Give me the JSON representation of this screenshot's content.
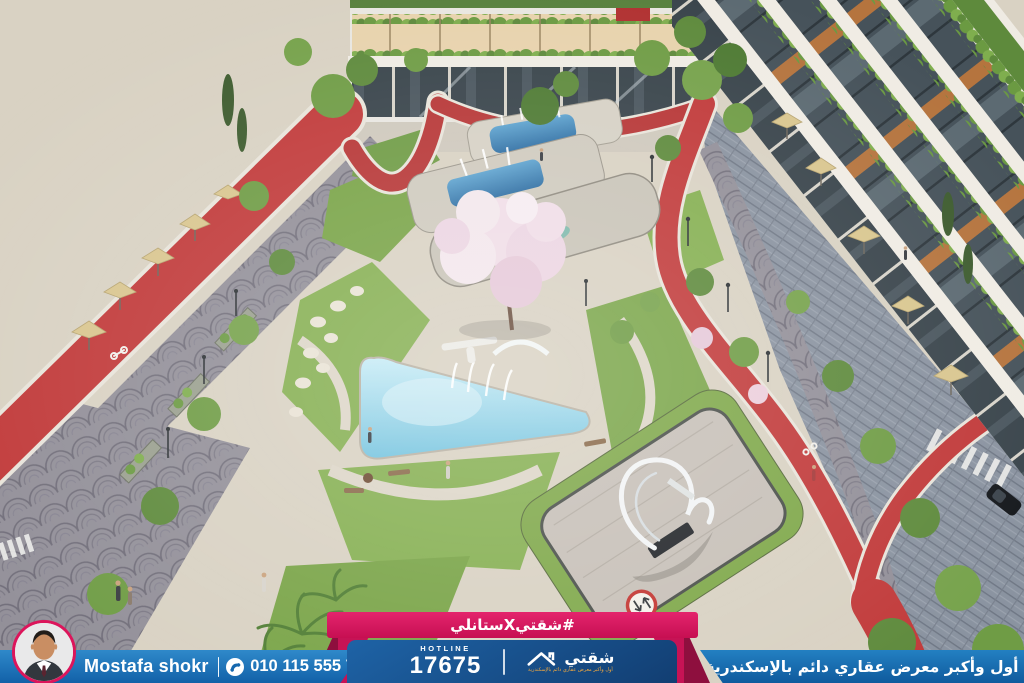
{
  "banner": {
    "ribbon": {
      "hashtag": "#شقتيXستانلي"
    },
    "agent": {
      "name": "Mostafa shokr",
      "phone": "010 115 555 76"
    },
    "hotline": {
      "label": "HOTLINE",
      "number": "17675"
    },
    "brand": {
      "name": "شقتي",
      "tagline": "أول وأكبر معرض عقاري دائم بالإسكندرية"
    },
    "slogan": "أول وأكبر معرض عقاري دائم بالإسكندرية",
    "colors": {
      "ribbon_pink": "#d9175e",
      "ribbon_fold_dark": "#8e0f3e",
      "bar_blue": "#1b74bd",
      "panel_navy": "#14497f",
      "tagline_orange": "#f3a93e",
      "text_white": "#ffffff",
      "avatar_ring": "#dc155b"
    }
  },
  "scene": {
    "type": "aerial-architectural-render-residential-compound",
    "elements": [
      "left-building",
      "right-building",
      "center-building",
      "red-running-track",
      "cobblestone-road",
      "fan-paved-promenade",
      "central-triangular-pool",
      "fountain-jets",
      "water-arch",
      "upper-terrace-pools",
      "blossom-tree",
      "sculpture-plaza",
      "white-sculpture",
      "ground-traffic-sign",
      "zebra-crossing",
      "cafe-umbrellas",
      "lawns",
      "stepping-stones",
      "palm-trees",
      "pedestrians",
      "benches",
      "lamp-posts",
      "car"
    ],
    "palette": {
      "grass": "#86b052",
      "paving": "#d9d2c3",
      "cobble_blue_gray": "#8a93a0",
      "fan_cobble": "#8e8b96",
      "track_red": "#c13a3a",
      "pool_blue": "#8ecbe2",
      "building_white": "#efece4",
      "glass_dark": "#46525a",
      "planter_green": "#6b9a42",
      "wood_orange": "#b5743e",
      "blossom_pink": "#f0dde7",
      "sculpture_white": "#f2f4f5"
    }
  }
}
